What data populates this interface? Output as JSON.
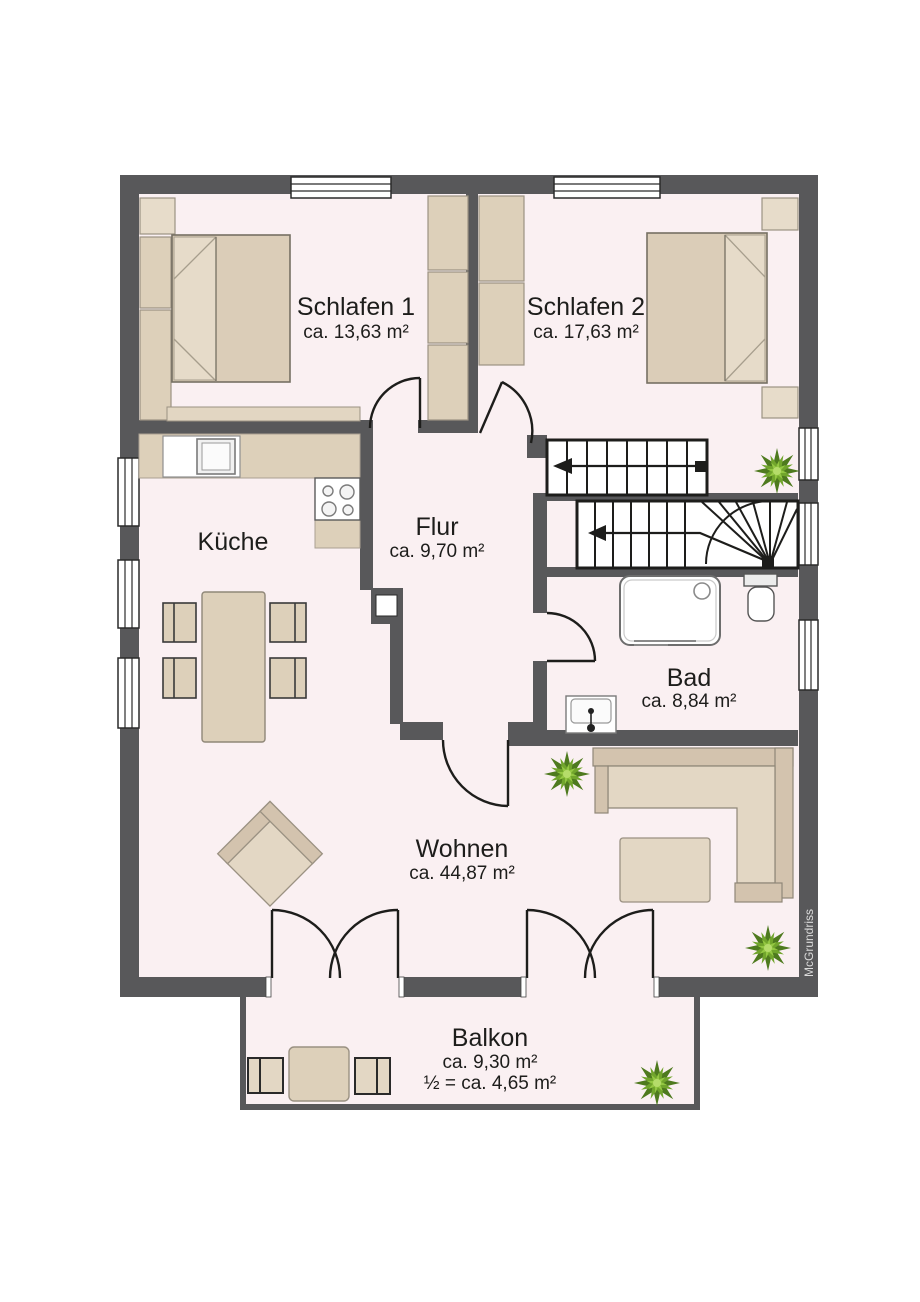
{
  "title": "Floor plan",
  "rooms": {
    "schlafen1": {
      "label": "Schlafen 1",
      "area": "ca. 13,63 m²"
    },
    "schlafen2": {
      "label": "Schlafen 2",
      "area": "ca. 17,63 m²"
    },
    "kueche": {
      "label": "Küche",
      "area": ""
    },
    "flur": {
      "label": "Flur",
      "area": "ca. 9,70 m²"
    },
    "bad": {
      "label": "Bad",
      "area": "ca. 8,84 m²"
    },
    "wohnen": {
      "label": "Wohnen",
      "area": "ca. 44,87 m²"
    },
    "balkon": {
      "label": "Balkon",
      "area": "ca. 9,30 m²",
      "area_half": "½ = ca. 4,65 m²"
    }
  },
  "watermark": "McGrundriss",
  "colors": {
    "wall": "#58585a",
    "floor": "#faf0f2",
    "furniture": "#ddd0ba",
    "furniture_light": "#e7dcca",
    "fixture_white": "#ffffff",
    "plant_green": "#71a52c",
    "line": "#1d1d1b"
  }
}
